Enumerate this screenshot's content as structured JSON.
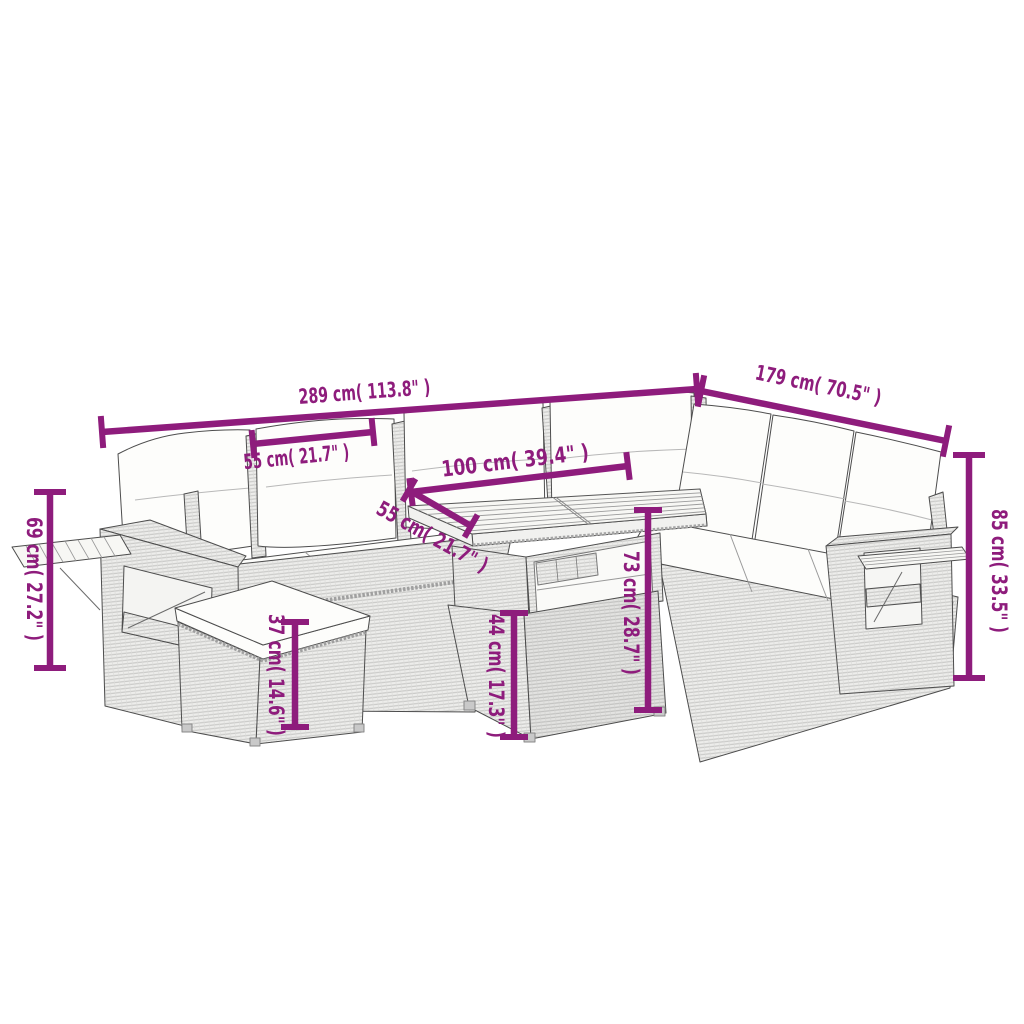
{
  "style": {
    "dimension_color": "#8e1c7c",
    "outline_color": "#4d4d4d",
    "background": "#ffffff",
    "cushion_color": "#fdfdfb",
    "rattan_base_color": "#ededeb"
  },
  "diagram": {
    "subject": "rattan garden lounge set with footstool and slatted-top table",
    "dimensions": {
      "overall_width": {
        "label": "289 cm( 113.8\" )"
      },
      "overall_depth": {
        "label": "179 cm( 70.5\" )"
      },
      "seat_width": {
        "label": "55 cm( 21.7\" )"
      },
      "table_length": {
        "label": "100 cm( 39.4\" )"
      },
      "table_depth": {
        "label": "55 cm( 21.7\" )"
      },
      "table_height": {
        "label": "73 cm( 28.7\" )"
      },
      "table_base_height": {
        "label": "44 cm( 17.3\" )"
      },
      "footstool_height": {
        "label": "37 cm( 14.6\" )"
      },
      "armrest_height": {
        "label": "69 cm( 27.2\" )"
      },
      "back_height": {
        "label": "85 cm( 33.5\" )"
      }
    }
  }
}
